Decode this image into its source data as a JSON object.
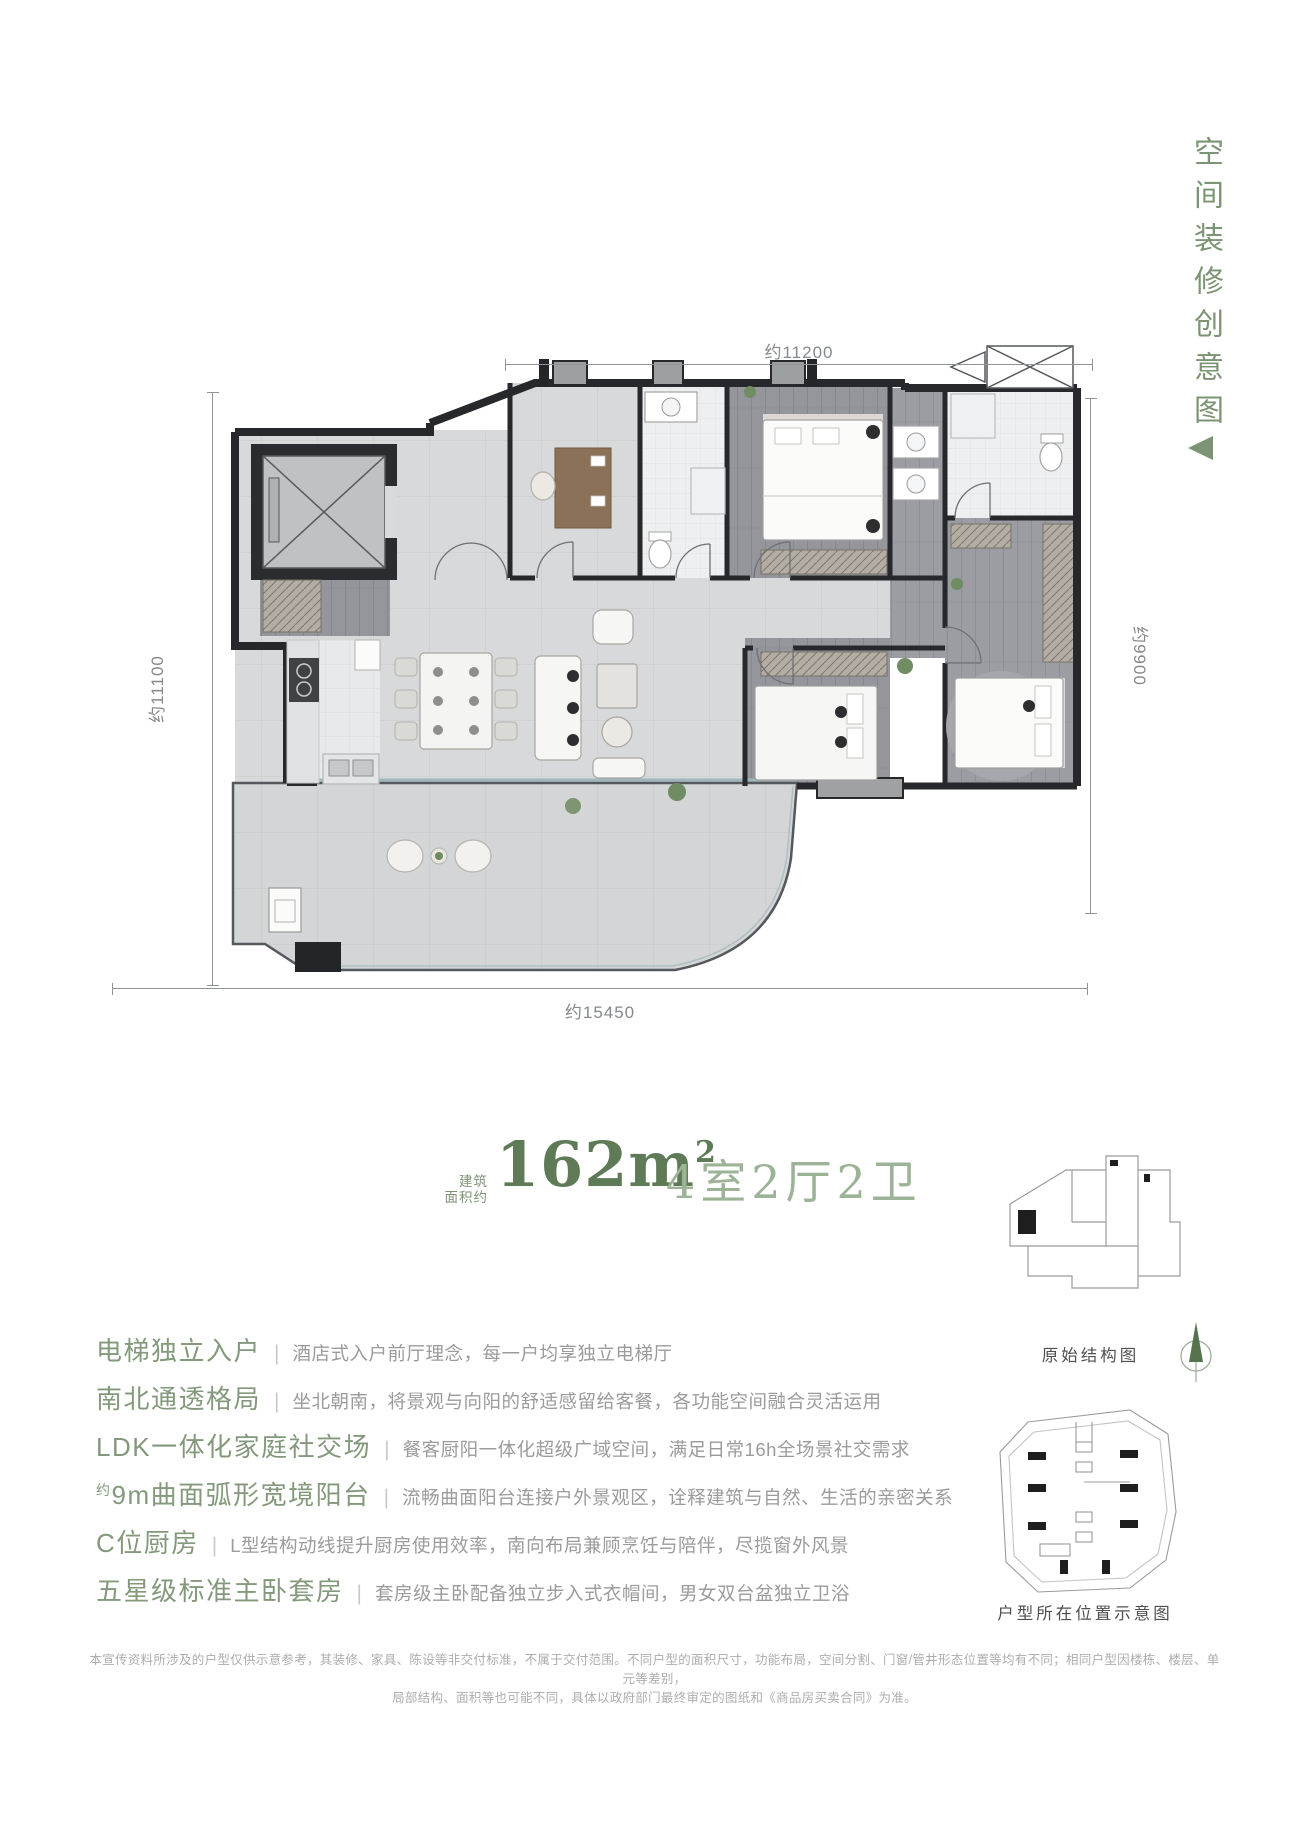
{
  "theme": {
    "accent_green": "#7c9473",
    "title_green": "#5e7a56",
    "light_green": "#9db397",
    "text_gray": "#9b9b9b"
  },
  "side_banner": {
    "text": "空间装修创意图"
  },
  "plan": {
    "dims": {
      "top": "约11200",
      "left": "约11100",
      "right": "约9900",
      "bottom": "约15450"
    }
  },
  "title": {
    "area_prefix": "建筑\n面积约",
    "area": "162m",
    "area_sup": "2",
    "layout": "4室2厅2卫"
  },
  "features": {
    "divider": "|",
    "items": [
      {
        "prefix": "",
        "heading": "电梯独立入户",
        "desc": "酒店式入户前厅理念，每一户均享独立电梯厅"
      },
      {
        "prefix": "",
        "heading": "南北通透格局",
        "desc": "坐北朝南，将景观与向阳的舒适感留给客餐，各功能空间融合灵活运用"
      },
      {
        "prefix": "",
        "heading": "LDK一体化家庭社交场",
        "desc": "餐客厨阳一体化超级广域空间，满足日常16h全场景社交需求"
      },
      {
        "prefix": "约",
        "heading": "9m曲面弧形宽境阳台",
        "desc": "流畅曲面阳台连接户外景观区，诠释建筑与自然、生活的亲密关系"
      },
      {
        "prefix": "",
        "heading": "C位厨房",
        "desc": "L型结构动线提升厨房使用效率，南向布局兼顾烹饪与陪伴，尽揽窗外风景"
      },
      {
        "prefix": "",
        "heading": "五星级标准主卧套房",
        "desc": "套房级主卧配备独立步入式衣帽间，男女双台盆独立卫浴"
      }
    ]
  },
  "diagrams": {
    "original_label": "原始结构图",
    "location_label": "户型所在位置示意图"
  },
  "disclaimer": {
    "line1": "本宣传资料所涉及的户型仅供示意参考，其装修、家具、陈设等非交付标准，不属于交付范围。不同户型的面积尺寸，功能布局，空间分割、门窗/管井形态位置等均有不同；相同户型因楼栋、楼层、单元等差别，",
    "line2": "局部结构、面积等也可能不同，具体以政府部门最终审定的图纸和《商品房买卖合同》为准。"
  }
}
